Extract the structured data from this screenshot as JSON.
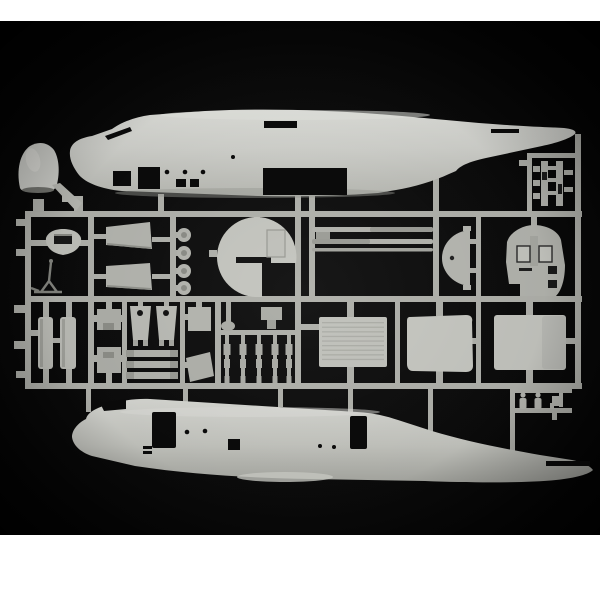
{
  "photo": {
    "description": "Product photograph of an unassembled light-grey plastic model kit sprue (military transport aircraft) on a black background with white top and bottom margins",
    "margin_top_px": 21,
    "margin_bottom_start_px": 535,
    "background": "#060606",
    "background_center": "#171717",
    "border": "#ffffff"
  },
  "palette": {
    "runner": "#b2b3ad",
    "plastic_light": "#d6d7d2",
    "plastic_mid": "#b9bab4",
    "plastic_dark": "#9a9b95",
    "cutout": "#0b0b0b",
    "shadow": "#1d1d1d"
  },
  "parts": [
    {
      "name": "fuselage-half-top",
      "label": "upper fuselage half"
    },
    {
      "name": "fuselage-half-bottom",
      "label": "lower fuselage half"
    },
    {
      "name": "nose-cone",
      "label": "nose cone"
    },
    {
      "name": "dome-window",
      "label": "oval dome window"
    },
    {
      "name": "antenna-a-frame",
      "label": "thin A-frame antenna"
    },
    {
      "name": "wedge-panel",
      "label": "two wedge panels"
    },
    {
      "name": "wheel-disc",
      "label": "four small wheel discs"
    },
    {
      "name": "round-bulkhead",
      "label": "notched round bulkhead"
    },
    {
      "name": "long-rod",
      "label": "three long slender rods"
    },
    {
      "name": "half-disc-panel",
      "label": "half-disc panel"
    },
    {
      "name": "cockpit-floor",
      "label": "cockpit floor with seats"
    },
    {
      "name": "detail-subframe",
      "label": "small-detail sub frame"
    },
    {
      "name": "tank-part",
      "label": "two rectangular tanks"
    },
    {
      "name": "bracket-part",
      "label": "two brackets"
    },
    {
      "name": "door-plate",
      "label": "two plates with holes"
    },
    {
      "name": "link-bar",
      "label": "three link bars"
    },
    {
      "name": "strut",
      "label": "five slender struts"
    },
    {
      "name": "ramp-panel-ribbed",
      "label": "ribbed ramp panel"
    },
    {
      "name": "door-panel-center",
      "label": "center door panel"
    },
    {
      "name": "door-panel-right",
      "label": "right door panel"
    },
    {
      "name": "crew-figures",
      "label": "small crew figures"
    },
    {
      "name": "sprue-runners",
      "label": "sprue runner frame"
    }
  ]
}
